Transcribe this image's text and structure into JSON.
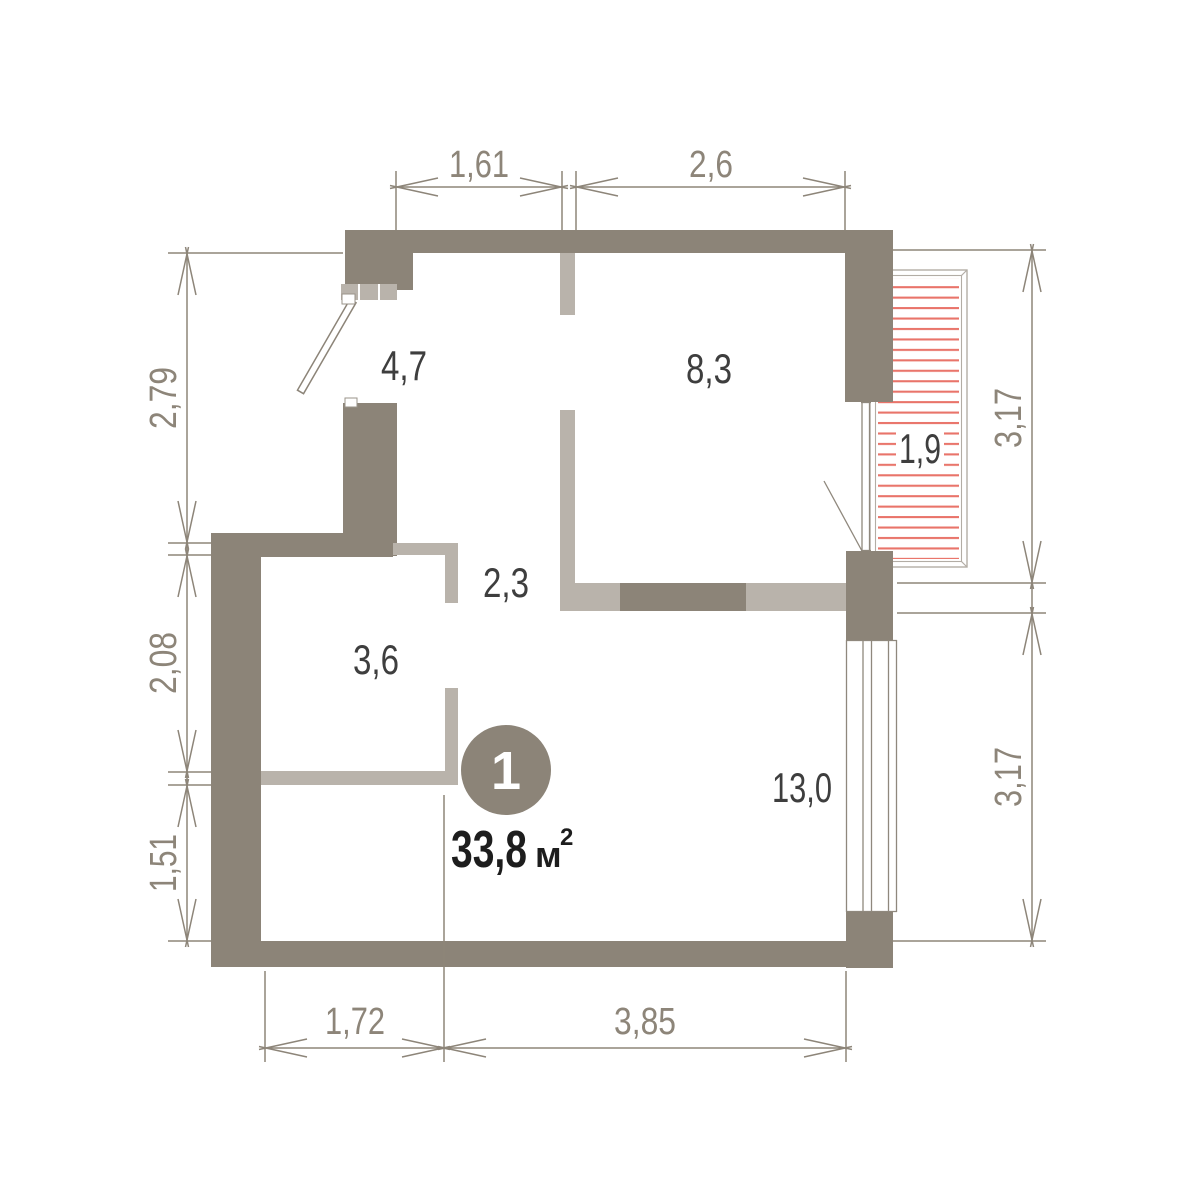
{
  "plan": {
    "unit": {
      "number": "1",
      "area_value": "33,8",
      "area_unit": "м",
      "area_sup": "2"
    },
    "rooms": [
      {
        "name": "hallway",
        "area": "4,7"
      },
      {
        "name": "bedroom",
        "area": "8,3"
      },
      {
        "name": "corridor",
        "area": "2,3"
      },
      {
        "name": "bathroom",
        "area": "3,6"
      },
      {
        "name": "living-room",
        "area": "13,0"
      },
      {
        "name": "balcony",
        "area": "1,9"
      }
    ],
    "dimensions": {
      "top": [
        {
          "label": "1,61"
        },
        {
          "label": "2,6"
        }
      ],
      "left": [
        {
          "label": "2,79"
        },
        {
          "label": "2,08"
        },
        {
          "label": "1,51"
        }
      ],
      "right": [
        {
          "label": "3,17"
        },
        {
          "label": "3,17"
        }
      ],
      "bottom": [
        {
          "label": "1,72"
        },
        {
          "label": "3,85"
        }
      ]
    },
    "colors": {
      "wall_dark": "#8c8478",
      "wall_light": "#b9b3ab",
      "balcony_hatch": "#e9746a",
      "dimension": "#8d8579",
      "room_label": "#3e3e3e",
      "area_text": "#1d1d1d",
      "unit_circle": "#8c8478"
    }
  }
}
